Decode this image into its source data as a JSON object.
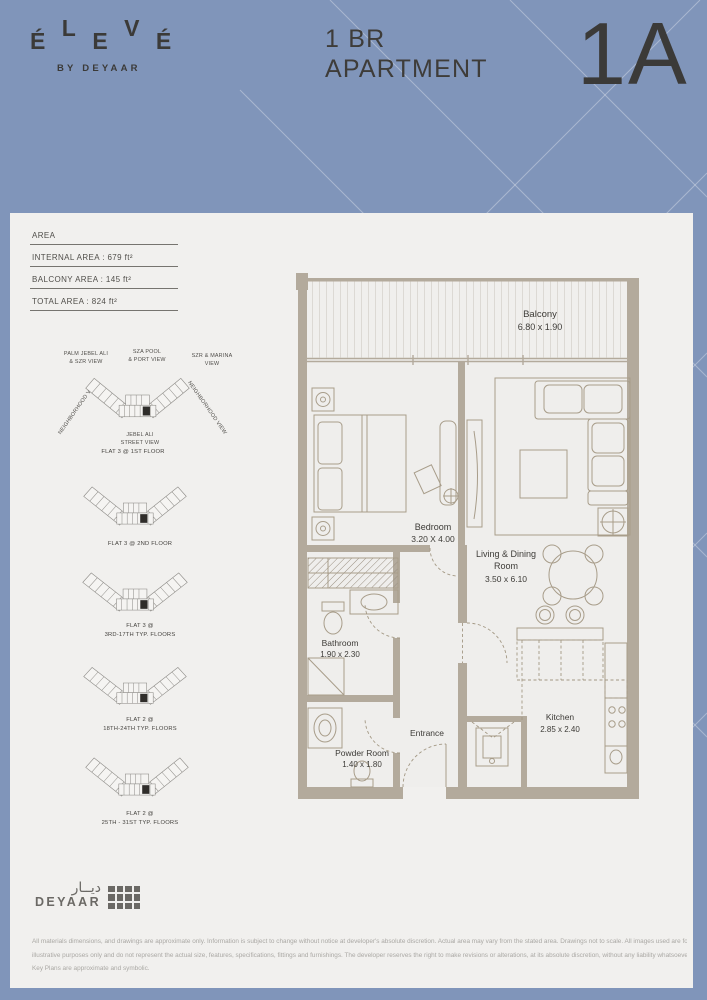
{
  "header": {
    "brand": {
      "letters": [
        "É",
        "L",
        "E",
        "V",
        "É"
      ],
      "byline": "BY DEYAAR"
    },
    "unit_type": {
      "line1": "1 BR",
      "line2": "APARTMENT"
    },
    "unit_code": "1A"
  },
  "area_table": {
    "title": "AREA",
    "rows": [
      "INTERNAL AREA : 679 ft²",
      "BALCONY AREA : 145 ft²",
      "TOTAL AREA : 824 ft²"
    ]
  },
  "key_plans": {
    "views": {
      "top_left": [
        "PALM JEBEL ALI",
        "& SZR VIEW"
      ],
      "top_center": [
        "SZA POOL",
        "& PORT VIEW"
      ],
      "top_right": [
        "SZR & MARINA",
        "VIEW"
      ],
      "left": "NEIGHBORHOOD VIEW",
      "right": "NEIGHBORHOOD VIEW",
      "bottom": [
        "JEBEL ALI",
        "STREET VIEW"
      ]
    },
    "plans": [
      {
        "caption1": "FLAT 3 @ 1ST FLOOR",
        "caption2": ""
      },
      {
        "caption1": "FLAT 3 @ 2ND FLOOR",
        "caption2": ""
      },
      {
        "caption1": "FLAT 3 @",
        "caption2": "3RD-17TH TYP. FLOORS"
      },
      {
        "caption1": "FLAT 2 @",
        "caption2": "18TH-24TH TYP. FLOORS"
      },
      {
        "caption1": "FLAT 2 @",
        "caption2": "25TH - 31ST TYP. FLOORS"
      }
    ]
  },
  "floor_plan": {
    "balcony": {
      "name": "Balcony",
      "dims": "6.80 x 1.90"
    },
    "bedroom": {
      "name": "Bedroom",
      "dims": "3.20 X 4.00"
    },
    "living": {
      "line1": "Living & Dining",
      "line2": "Room",
      "dims": "3.50 x 6.10"
    },
    "bathroom": {
      "name": "Bathroom",
      "dims": "1.90 x 2.30"
    },
    "powder": {
      "name": "Powder Room",
      "dims": "1.40 x 1.80"
    },
    "entrance": {
      "name": "Entrance"
    },
    "kitchen": {
      "name": "Kitchen",
      "dims": "2.85 x 2.40"
    }
  },
  "footer": {
    "logo": {
      "arabic": "ديــار",
      "latin": "DEYAAR"
    },
    "disclaimer": [
      "All materials dimensions, and drawings are approximate only. Information is subject to change without notice at developer's absolute discretion. Actual area may vary from the stated area. Drawings not to scale. All images used are for",
      "illustrative purposes only and do not represent the actual size, features, specifications, fittings and furnishings. The developer reserves the right to make revisions or alterations, at its absolute discretion, without any liability whatsoever.",
      "Key Plans are approximate and symbolic."
    ]
  },
  "colors": {
    "background": "#8095ba",
    "panel": "#f1f0ee",
    "ink": "#3b3a38",
    "wall": "#b3aa9c",
    "highlight_unit": "#2f2d2a"
  }
}
